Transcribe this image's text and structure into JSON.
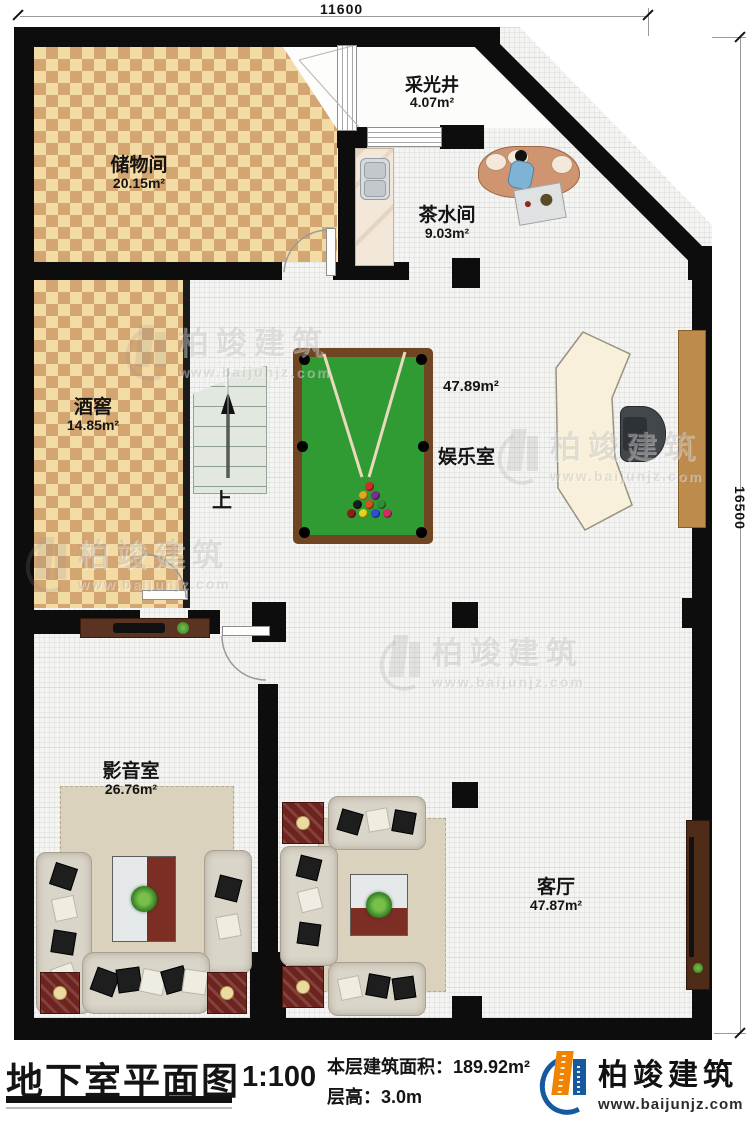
{
  "plan": {
    "dimensions": {
      "top": "11600",
      "right": "16500"
    },
    "stairs_label": "上",
    "rooms": [
      {
        "id": "storage",
        "name": "储物间",
        "area": "20.15m²"
      },
      {
        "id": "lightwell",
        "name": "采光井",
        "area": "4.07m²"
      },
      {
        "id": "tea",
        "name": "茶水间",
        "area": "9.03m²"
      },
      {
        "id": "wine",
        "name": "酒窖",
        "area": "14.85m²"
      },
      {
        "id": "entertainment",
        "name": "娱乐室",
        "area": "47.89m²"
      },
      {
        "id": "media",
        "name": "影音室",
        "area": "26.76m²"
      },
      {
        "id": "living",
        "name": "客厅",
        "area": "47.87m²"
      }
    ]
  },
  "watermark": {
    "brand": "柏竣建筑",
    "url": "www.baijunjz.com"
  },
  "title_block": {
    "title": "地下室平面图",
    "scale": "1:100",
    "area_label": "本层建筑面积：",
    "area_value": "189.92m²",
    "height_label": "层高：",
    "height_value": "3.0m"
  },
  "brand": {
    "name": "柏竣建筑",
    "url": "www.baijunjz.com"
  }
}
